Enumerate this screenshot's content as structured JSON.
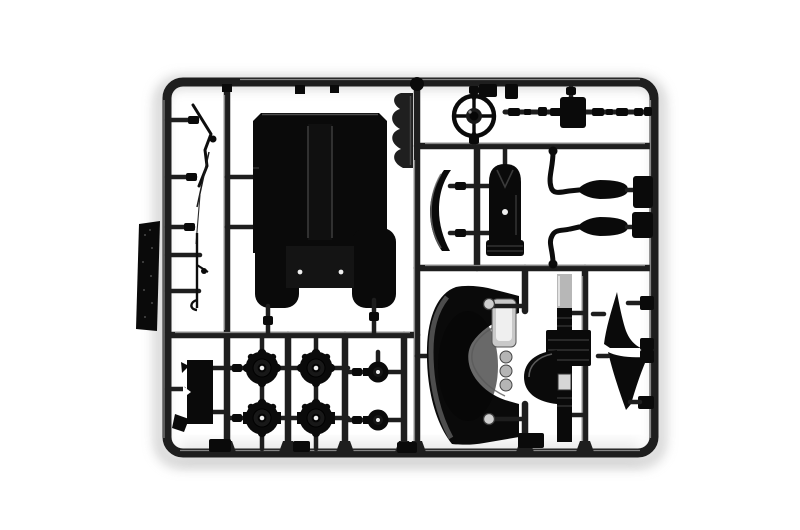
{
  "scene": {
    "type": "photograph",
    "subject": "Black injection-molded plastic model kit sprue (parts tree) photographed on a white background",
    "background": "#ffffff"
  },
  "colors": {
    "bg": "#ffffff",
    "runner": "#1e1e1e",
    "runner-hi": "#a8a8a8",
    "plastic": "#0a0a0a",
    "detail": "#3a3a3a",
    "light": "#c9c9c9",
    "glint": "#eeeeee",
    "shadow": "#9c9c9c"
  },
  "counts": {
    "large_wheel_hubs": 4,
    "small_hubs": 2,
    "mufflers": 2,
    "triangular_brackets": 2
  },
  "parts": {
    "frame": {
      "name": "sprue-frame",
      "desc": "rounded rectangular runner frame with internal rails"
    },
    "tread_plate": {
      "name": "textured-plate-part",
      "desc": "tall textured plate attached outside the left rail"
    },
    "sway_bar": {
      "name": "bent-rod-part",
      "desc": "thin bent stabilizer rod, upper-left cell"
    },
    "lever": {
      "name": "lever-rod-part",
      "desc": "thin lever rod with hook, left cell"
    },
    "floor_panel": {
      "name": "cab-floor-panel-part",
      "desc": "large dark panel with two lower lobes and recessed center"
    },
    "scallop_bracket": {
      "name": "scalloped-bracket-part",
      "desc": "serrated bracket beside ball pin"
    },
    "ball_pin": {
      "name": "ball-pin",
      "desc": "spherical pin on top of center runner"
    },
    "steering_wheel": {
      "name": "steering-wheel-part",
      "desc": "steering wheel with hub and spokes"
    },
    "parts_runner": {
      "name": "bushing-runner",
      "desc": "horizontal runner with small bushings and junction box"
    },
    "muffler_upper": {
      "name": "exhaust-muffler-upper",
      "desc": "spindle muffler with S-curved pipe"
    },
    "muffler_lower": {
      "name": "exhaust-muffler-lower",
      "desc": "spindle muffler with S-curved pipe"
    },
    "curved_visor": {
      "name": "curved-blade-part",
      "desc": "crescent shaped panel"
    },
    "air_tank": {
      "name": "cylindrical-tank-part",
      "desc": "round-topped cylinder with skirt"
    },
    "wheel_hub": {
      "name": "wheel-hub-part",
      "desc": "round brake-drum hub with lugs and center hole"
    },
    "small_hub": {
      "name": "small-hub-part",
      "desc": "small round hub with center hole"
    },
    "axle_bracket": {
      "name": "axle-bracket-part",
      "desc": "notched bracket, lower-left cell"
    },
    "dashboard_fender": {
      "name": "dashboard-fender-part",
      "desc": "large C-curved fender with instrument cluster, gauges and screws"
    },
    "chassis_member": {
      "name": "chassis-member-part",
      "desc": "vertical member with gearbox block and dome cover"
    },
    "bracket_upper": {
      "name": "triangular-bracket-upper",
      "desc": "fin-shaped bracket"
    },
    "bracket_lower": {
      "name": "triangular-bracket-lower",
      "desc": "fin-shaped bracket"
    }
  }
}
